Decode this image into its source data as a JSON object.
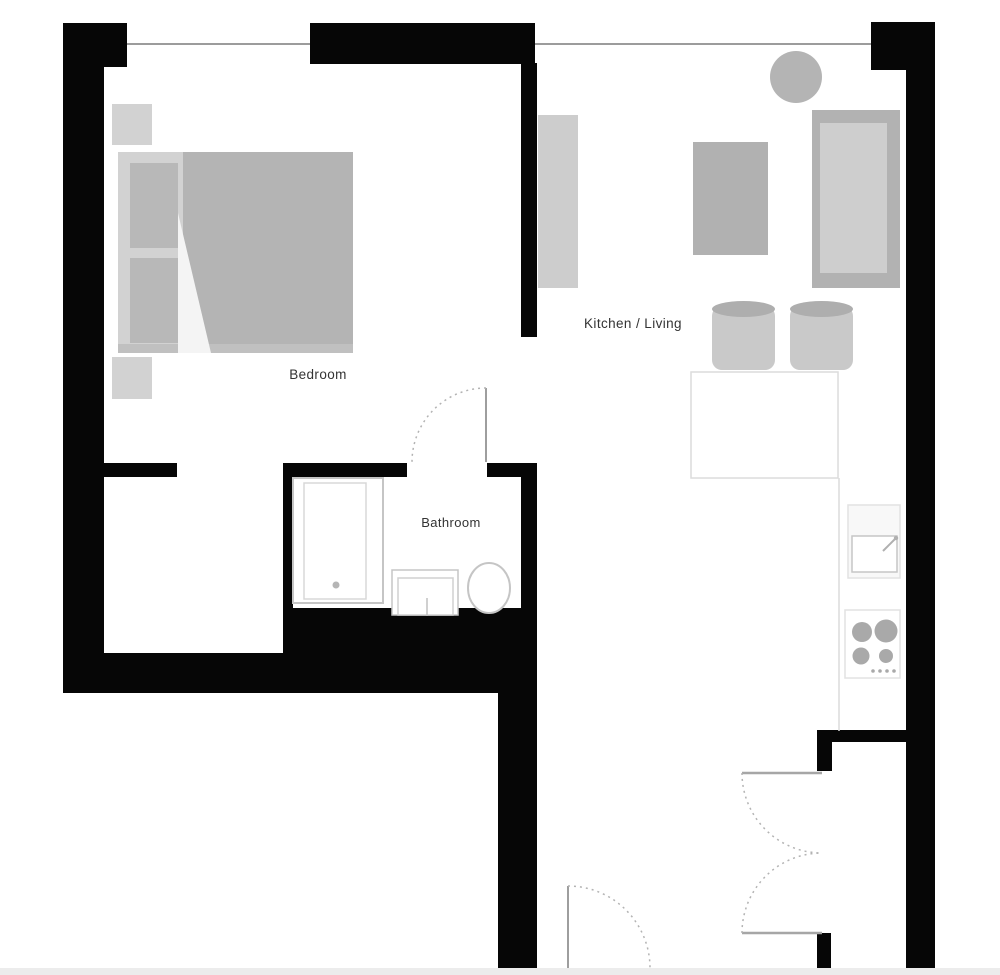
{
  "labels": {
    "bedroom": "Bedroom",
    "kitchen_living": "Kitchen / Living",
    "bathroom": "Bathroom"
  },
  "colors": {
    "wall": "#060606",
    "background": "#ffffff",
    "window_line": "#9c9c9c",
    "furniture_mid_gray": "#b4b4b4",
    "furniture_light_gray": "#cdcdcd",
    "bed_base_gray": "#d2d2d2",
    "pillow_gray": "#b8b8b8",
    "stool_top_gray": "#aeaeae",
    "counter_outline": "#dcdcdc",
    "fixture_outline": "#c5c5c5",
    "burner_gray": "#a9a9a9",
    "door_leaf_line": "#9e9e9e",
    "door_arc_dashed": "#b3b3b3",
    "label_text": "#333333",
    "bottom_strip": "#ececec"
  }
}
